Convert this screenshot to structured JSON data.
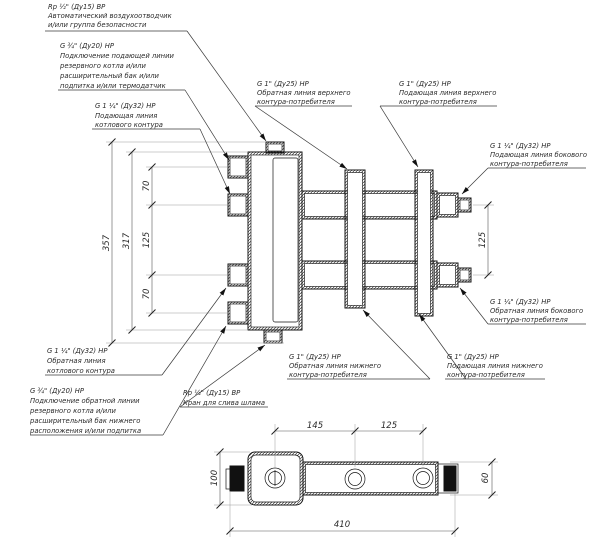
{
  "drawing": {
    "labels": {
      "air_vent": {
        "l1": "Rp ½\" (Ду15) ВР",
        "l2": "Автоматический воздухоотводчик",
        "l3": "и/или группа безопасности"
      },
      "reserve_supply": {
        "l1": "G ¾\" (Ду20) НР",
        "l2": "Подключение подающей линии",
        "l3": "резервного котла и/или",
        "l4": "расширительный бак и/или",
        "l5": "подпитка и/или термодатчик"
      },
      "boiler_supply": {
        "l1": "G 1 ¼\" (Ду32) НР",
        "l2": "Подающая линия",
        "l3": "котлового контура"
      },
      "upper_return": {
        "l1": "G 1\" (Ду25) НР",
        "l2": "Обратная линия верхнего",
        "l3": "контура-потребителя"
      },
      "upper_supply": {
        "l1": "G 1\" (Ду25) НР",
        "l2": "Подающая линия верхнего",
        "l3": "контура-потребителя"
      },
      "side_supply": {
        "l1": "G 1 ¼\" (Ду32) НР",
        "l2": "Подающая линия бокового",
        "l3": "контура-потребителя"
      },
      "side_return": {
        "l1": "G 1 ¼\" (Ду32) НР",
        "l2": "Обратная линия бокового",
        "l3": "контура-потребителя"
      },
      "boiler_return": {
        "l1": "G 1 ¼\" (Ду32) НР",
        "l2": "Обратная линия",
        "l3": "котлового контура"
      },
      "reserve_return": {
        "l1": "G ¾\" (Ду20) НР",
        "l2": "Подключение обратной линии",
        "l3": "резервного котла и/или",
        "l4": "расширительный бак нижнего",
        "l5": "расположения и/или подпитка"
      },
      "drain": {
        "l1": "Rp ½\" (Ду15) ВР",
        "l2": "Кран для слива шлама"
      },
      "lower_return": {
        "l1": "G 1\" (Ду25) НР",
        "l2": "Обратная линия нижнего",
        "l3": "контура-потребителя"
      },
      "lower_supply": {
        "l1": "G 1\" (Ду25) НР",
        "l2": "Подающая линия нижнего",
        "l3": "контура-потребителя"
      }
    },
    "dimensions": {
      "overall_height": "357",
      "body_height": "317",
      "port_gap_top": "70",
      "port_gap_mid": "125",
      "port_gap_bottom": "70",
      "side_ports_gap": "125",
      "top_view_gap_1": "145",
      "top_view_gap_2": "125",
      "overall_length": "410",
      "body_width": "100",
      "manifold_width": "60"
    }
  }
}
